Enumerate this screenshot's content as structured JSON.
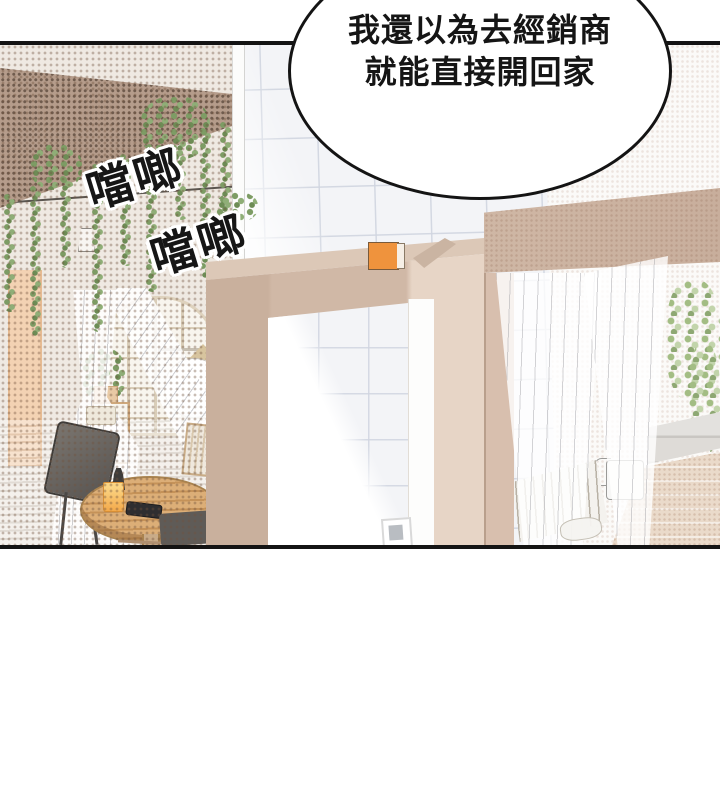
{
  "panel": {
    "type": "comic-panel",
    "speech_bubble": {
      "line1": "我還以為去經銷商",
      "line2": "就能直接開回家"
    },
    "sfx": {
      "clang1": "噹啷",
      "clang2": "噹啷"
    },
    "colors": {
      "ink": "#141414",
      "bubble_bg": "#ffffff",
      "door_tan": "#d0b8a6",
      "doorway_header": "#cdb5a3",
      "pergola_brown": "#b59c8b",
      "vine_green": "#7d9c64",
      "orange_object": "#ef933d",
      "drink_orange": "#f4ae4f",
      "table_wood": "#d7a670",
      "tile_wall": "#f3f4f7",
      "brick_wall": "#eadaca"
    }
  }
}
